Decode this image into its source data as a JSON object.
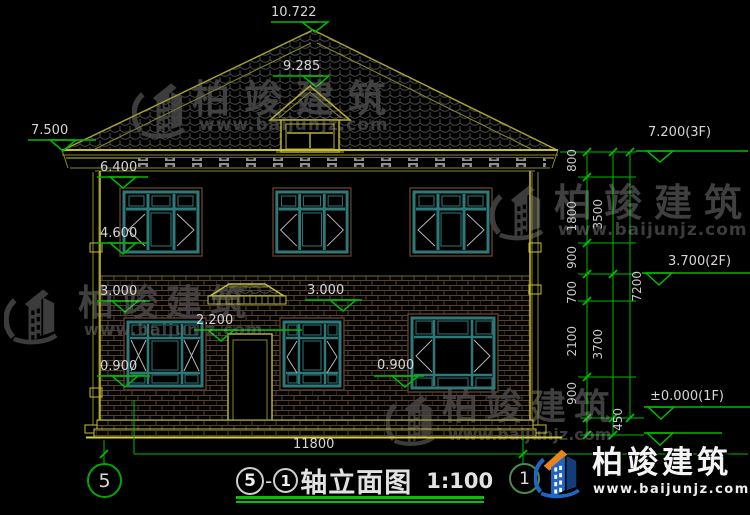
{
  "elevations": {
    "ridge": "10.722",
    "dormer": "9.285",
    "eave": "7.500",
    "win2_head": "6.400",
    "win2_sill": "4.600",
    "floor_left": "3.000",
    "door_head": "2.200",
    "sill_left": "0.900",
    "floor_mid": "3.000",
    "sill_mid": "0.900",
    "roof_right": "7.200(3F)",
    "level2_right": "3.700(2F)",
    "ground_right": "±0.000(1F)"
  },
  "dimensions": {
    "chain_inner": [
      "800",
      "1800",
      "900",
      "700",
      "2100",
      "900"
    ],
    "chain_mid": [
      "3500",
      "3700"
    ],
    "chain_outer": [
      "7200"
    ],
    "plinth": "450",
    "width": "11800"
  },
  "axes": {
    "left": "5",
    "right": "1"
  },
  "title_block": {
    "axis_a": "5",
    "separator": "-",
    "axis_b": "1",
    "name": "轴立面图",
    "scale": "1:100"
  },
  "watermark": {
    "brand": "柏竣建筑",
    "site": "www.baijunjz.com"
  },
  "logo": {
    "brand": "柏竣建筑",
    "site": "www.baijunjz.com"
  },
  "colors": {
    "dim_green": "#00bc00",
    "line_yellow": "#c8c034",
    "window_teal": "#2e7878",
    "brick_mortar": "#55412f",
    "watermark_gray": "#3f3f3f",
    "logo_blue": "#1e66c4",
    "logo_orange": "#e8831d"
  }
}
